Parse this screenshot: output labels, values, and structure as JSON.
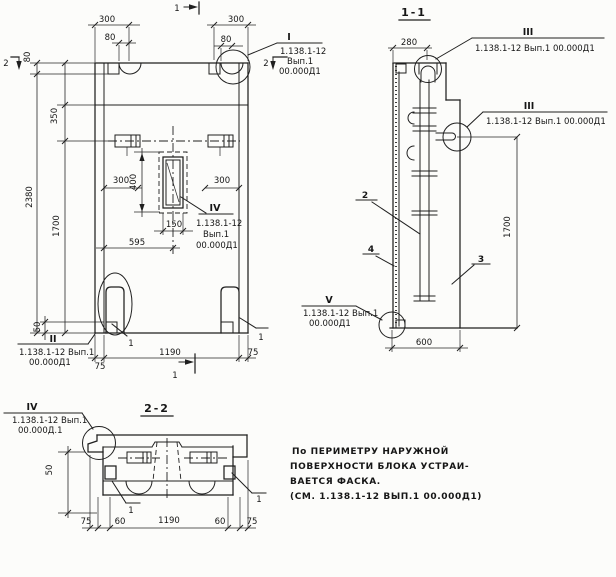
{
  "palette": {
    "paper": "#fcfcfa",
    "ink": "#1f1f1f"
  },
  "fv": {
    "marker_top": "1",
    "marker_bottom": "1",
    "marker_left": "2",
    "marker_right": "2",
    "d300l": "300",
    "d80tl": "80",
    "d300r": "300",
    "d80tr": "80",
    "d80side": "80",
    "d350": "350",
    "d2380": "2380",
    "d1700": "1700",
    "d400": "400",
    "d300ml": "300",
    "d300mr": "300",
    "d150": "150",
    "d595": "595",
    "d50": "50",
    "d75l": "75",
    "d1190": "1190",
    "d75r": "75",
    "lead1l": "1",
    "lead1r": "1",
    "cI": {
      "n": "I",
      "l1": "1.138.1-12",
      "l2": "Вып.1",
      "l3": "00.000Д1"
    },
    "cII": {
      "n": "II",
      "l1": "1.138.1-12 Вып.1",
      "l2": "00.000Д1"
    },
    "cIV": {
      "n": "IV",
      "l1": "1.138.1-12",
      "l2": "Вып.1",
      "l3": "00.000Д1"
    }
  },
  "s11": {
    "title": "1-1",
    "d280": "280",
    "d1700": "1700",
    "d600": "600",
    "p2": "2",
    "p3": "3",
    "p4": "4",
    "cIIIa": {
      "n": "III",
      "t": "1.138.1-12 Вып.1 00.000Д1"
    },
    "cIIIb": {
      "n": "III",
      "t": "1.138.1-12 Вып.1 00.000Д1"
    },
    "cV": {
      "n": "V",
      "l1": "1.138.1-12 Вып.1",
      "l2": "00.000Д1"
    }
  },
  "s22": {
    "title": "2-2",
    "d50": "50",
    "d75l": "75",
    "d60l": "60",
    "d1190": "1190",
    "d60r": "60",
    "d75r": "75",
    "lead1l": "1",
    "lead1r": "1",
    "cIV": {
      "n": "IV",
      "l1": "1.138.1-12 Вып.1",
      "l2": "00.000Д.1"
    }
  },
  "note": {
    "l1": "По ПЕРИМЕТРУ НАРУЖНОЙ",
    "l2": "ПОВЕРХНОСТИ БЛОКА УСТРАИ-",
    "l3": "ВАЕТСЯ ФАСКА.",
    "l4": "(СМ. 1.138.1-12 ВЫП.1 00.000Д1)"
  }
}
